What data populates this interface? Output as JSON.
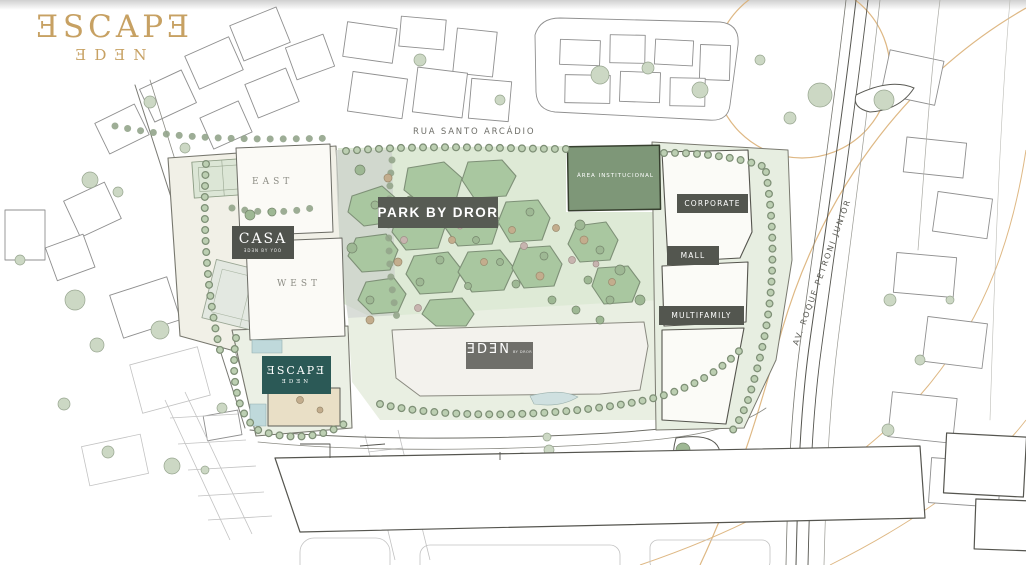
{
  "logo": {
    "title": "ƎSCAPƎ",
    "subtitle": "ƎDƎN"
  },
  "streets": {
    "rua": "RUA SANTO ARCÁDIO",
    "avenue": "AV. ROQUE PETRONI JUNIOR"
  },
  "areas": {
    "park": {
      "label": "PARK BY DROR"
    },
    "institutional": {
      "label": "ÁREA INSTITUCIONAL"
    },
    "corporate": {
      "label": "CORPORATE"
    },
    "mall": {
      "label": "MALL"
    },
    "multifamily": {
      "label": "MULTIFAMILY"
    },
    "casa": {
      "title": "CASA",
      "subtitle": "ƎDƎN BY YOO"
    },
    "east": {
      "label": "EAST"
    },
    "west": {
      "label": "WEST"
    },
    "eden": {
      "label": "ƎDƎN",
      "suffix": "BY DROR"
    },
    "escape": {
      "title": "ƎSCAPƎ",
      "subtitle": "ƎDƎN"
    }
  },
  "colors": {
    "gold": "#c7a163",
    "badge_dark": "#53564f",
    "badge_gray": "#6f6f6a",
    "teal": "#2b5956",
    "institutional_green": "#7e9778",
    "park_cell_green": "#a9c7a0",
    "park_bg": "#deead6"
  }
}
